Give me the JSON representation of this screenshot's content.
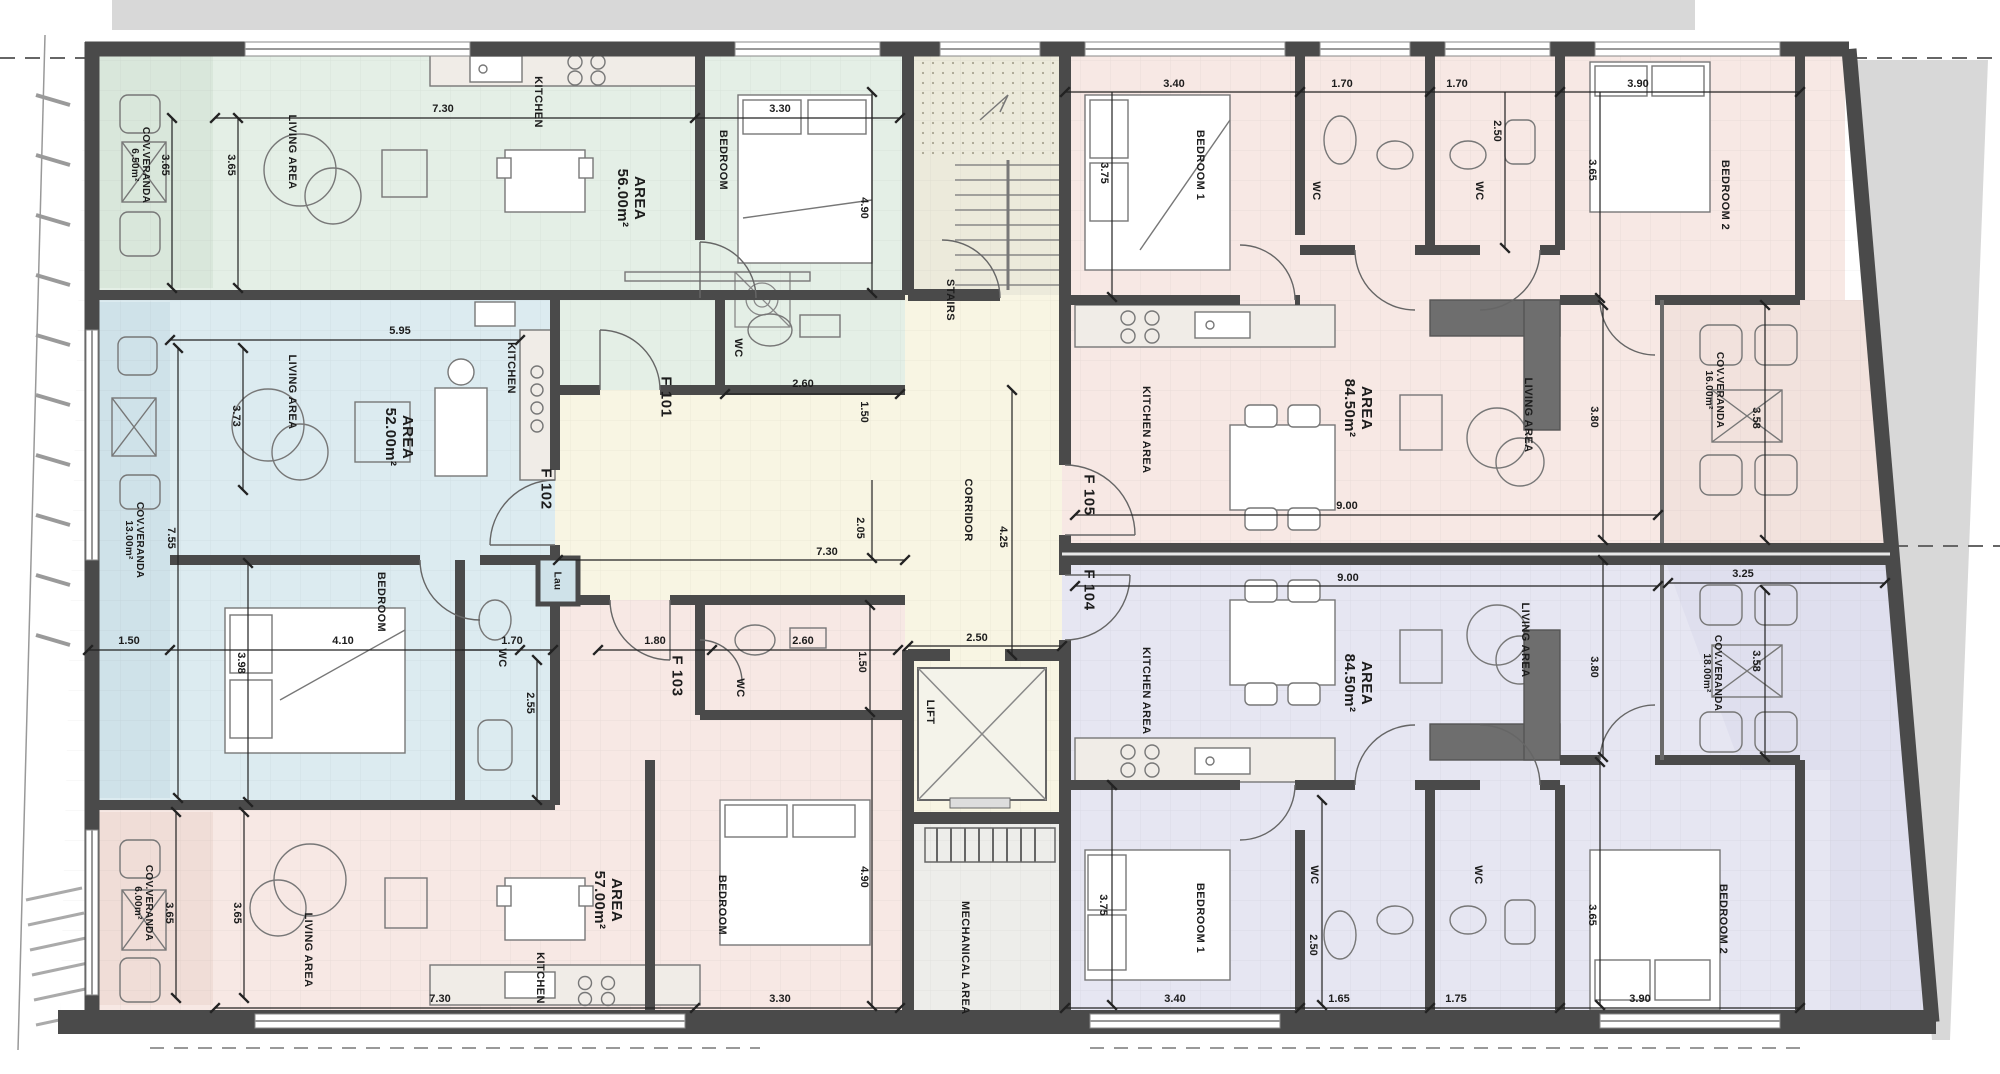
{
  "colors": {
    "wall": "#4a4a4a",
    "f101_green": "#e4efe6",
    "f102_blue": "#dcebf0",
    "f103_pink": "#f7e8e4",
    "f104_purple": "#e6e6f2",
    "f105_pink": "#f7e8e4",
    "core_cream": "#f8f5e3",
    "site_gray": "#d8d8d8"
  },
  "core": {
    "stairs": "STAIRS",
    "corridor": "CORRIDOR",
    "lift": "LIFT",
    "mechanical": "MECHANICAL AREA",
    "dims": {
      "w730": "7.30",
      "w205": "2.05",
      "w425": "4.25",
      "w250": "2.50"
    }
  },
  "f101": {
    "label": "F 101",
    "area_title": "AREA",
    "area_value": "56.00m²",
    "veranda": "COV.VERANDA",
    "veranda_area": "6.50m²",
    "living": "LIVING AREA",
    "kitchen": "KITCHEN",
    "bedroom": "BEDROOM",
    "wc": "WC",
    "dims": {
      "w730": "7.30",
      "w330": "3.30",
      "h365a": "3.65",
      "h365b": "3.65",
      "h490": "4.90",
      "w260": "2.60",
      "h150": "1.50"
    }
  },
  "f102": {
    "label": "F 102",
    "area_title": "AREA",
    "area_value": "52.00m²",
    "veranda": "COV.VERANDA",
    "veranda_area": "13.00m²",
    "living": "LIVING AREA",
    "kitchen": "KITCHEN",
    "bedroom": "BEDROOM",
    "wc": "WC",
    "laundry": "Lau",
    "dims": {
      "w595": "5.95",
      "h373": "3.73",
      "h755": "7.55",
      "w150": "1.50",
      "w410": "4.10",
      "h398": "3.98",
      "w170": "1.70",
      "h255": "2.55"
    }
  },
  "f103": {
    "label": "F 103",
    "area_title": "AREA",
    "area_value": "57.00m²",
    "veranda": "COV.VERANDA",
    "veranda_area": "6.00m²",
    "living": "LIVING AREA",
    "kitchen": "KITCHEN",
    "bedroom": "BEDROOM",
    "wc": "WC",
    "dims": {
      "w180": "1.80",
      "w260": "2.60",
      "h150": "1.50",
      "w730": "7.30",
      "w330": "3.30",
      "h365a": "3.65",
      "h365b": "3.65",
      "h490": "4.90"
    }
  },
  "f105": {
    "label": "F 105",
    "area_title": "AREA",
    "area_value": "84.50m²",
    "veranda": "COV.VERANDA",
    "veranda_area": "16.00m²",
    "kitchen": "KITCHEN AREA",
    "living": "LIVING AREA",
    "bedroom1": "BEDROOM 1",
    "bedroom2": "BEDROOM 2",
    "wc1": "WC",
    "wc2": "WC",
    "dims": {
      "w340": "3.40",
      "h375": "3.75",
      "w170a": "1.70",
      "w170b": "1.70",
      "h250": "2.50",
      "w390": "3.90",
      "h365": "3.65",
      "w900": "9.00",
      "h380": "3.80",
      "h358": "3.58"
    }
  },
  "f104": {
    "label": "F 104",
    "area_title": "AREA",
    "area_value": "84.50m²",
    "veranda": "COV.VERANDA",
    "veranda_area": "18.00m²",
    "kitchen": "KITCHEN AREA",
    "living": "LIVING AREA",
    "bedroom1": "BEDROOM 1",
    "bedroom2": "BEDROOM 2",
    "wc1": "WC",
    "wc2": "WC",
    "dims": {
      "w900": "9.00",
      "h380": "3.80",
      "w325": "3.25",
      "h358": "3.58",
      "h375": "3.75",
      "w340": "3.40",
      "h250": "2.50",
      "w165": "1.65",
      "w175": "1.75",
      "w390": "3.90",
      "h365": "3.65"
    }
  }
}
